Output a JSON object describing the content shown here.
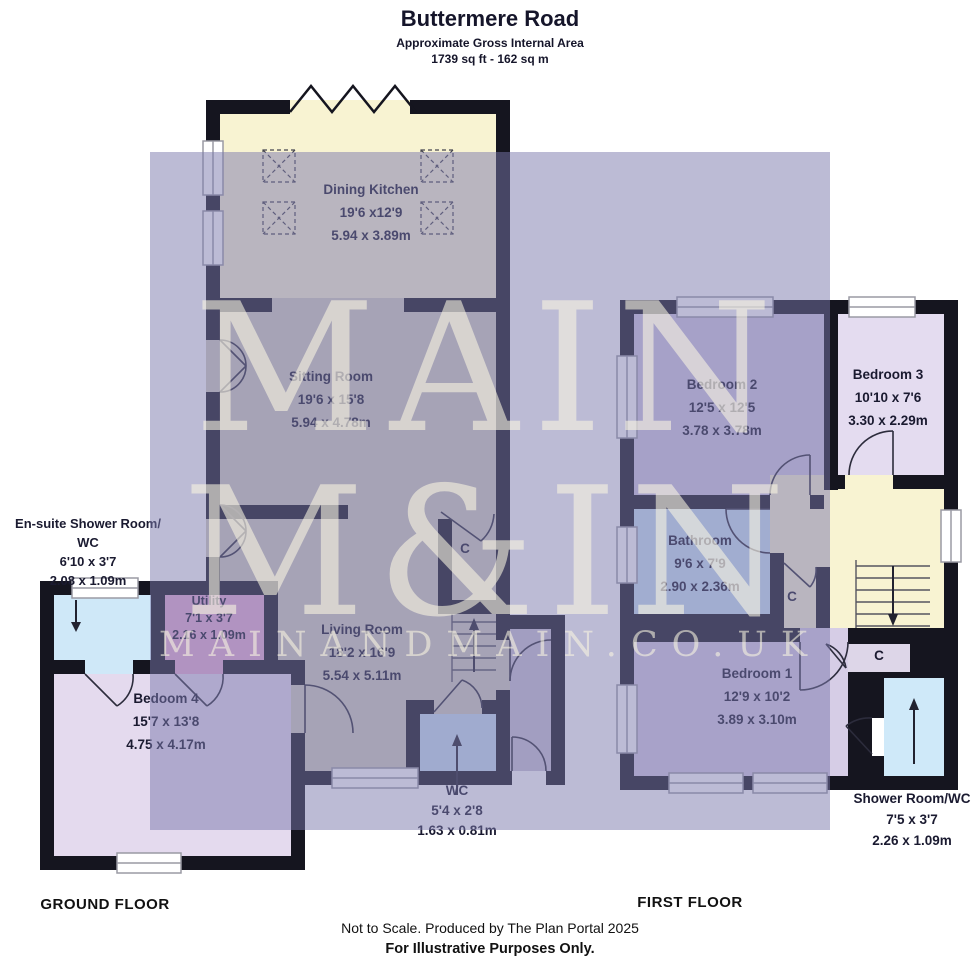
{
  "header": {
    "title": "Buttermere Road",
    "subtitle": "Approximate Gross Internal Area",
    "area": "1739 sq ft - 162 sq m"
  },
  "watermark": {
    "line1": "MAIN",
    "line2": "M&IN",
    "line3": "MAINANDMAIN.CO.UK"
  },
  "ground_floor": {
    "label": "GROUND FLOOR",
    "cupboard_label": "C",
    "rooms": [
      {
        "name": "Dining Kitchen",
        "imperial": "19'6 x12'9",
        "metric": "5.94 x 3.89m"
      },
      {
        "name": "Sitting Room",
        "imperial": "19'6 x 15'8",
        "metric": "5.94 x 4.78m"
      },
      {
        "name": "Living Room",
        "imperial": "18'2 x 16'9",
        "metric": "5.54 x 5.11m"
      },
      {
        "name": "Utility",
        "imperial": "7'1 x 3'7",
        "metric": "2.16 x 1.09m"
      },
      {
        "name": "En-suite Shower Room/",
        "name_line2": "WC",
        "imperial": "6'10 x 3'7",
        "metric": "2.08 x 1.09m"
      },
      {
        "name": "Bedoom 4",
        "imperial": "15'7 x 13'8",
        "metric": "4.75 x 4.17m"
      },
      {
        "name": "WC",
        "imperial": "5'4 x 2'8",
        "metric": "1.63 x 0.81m"
      }
    ]
  },
  "first_floor": {
    "label": "FIRST FLOOR",
    "cupboard_label": "C",
    "rooms": [
      {
        "name": "Bedroom 2",
        "imperial": "12'5 x 12'5",
        "metric": "3.78 x 3.78m"
      },
      {
        "name": "Bedroom 3",
        "imperial": "10'10 x 7'6",
        "metric": "3.30 x 2.29m"
      },
      {
        "name": "Bathroom",
        "imperial": "9'6 x 7'9",
        "metric": "2.90 x 2.36m"
      },
      {
        "name": "Bedroom 1",
        "imperial": "12'9 x 10'2",
        "metric": "3.89 x 3.10m"
      },
      {
        "name": "Shower Room/WC",
        "imperial": "7'5 x 3'7",
        "metric": "2.26 x 1.09m"
      }
    ]
  },
  "footer": {
    "line1": "Not to Scale. Produced by The Plan Portal 2025",
    "line2": "For Illustrative Purposes Only."
  },
  "colors": {
    "wall": "#15151f",
    "kitchen_cream": "#f8f3d2",
    "floor_tan": "#d2cfc0",
    "bedroom_lavender": "#e4daee",
    "bedroom2_lavender": "#d2cae4",
    "utility_pink": "#e8aed6",
    "bath_blue": "#c8e2f4",
    "shower_blue": "#cfe9f9",
    "watermark_tint": "#7a78ac",
    "watermark_text": "#faf6e2"
  }
}
